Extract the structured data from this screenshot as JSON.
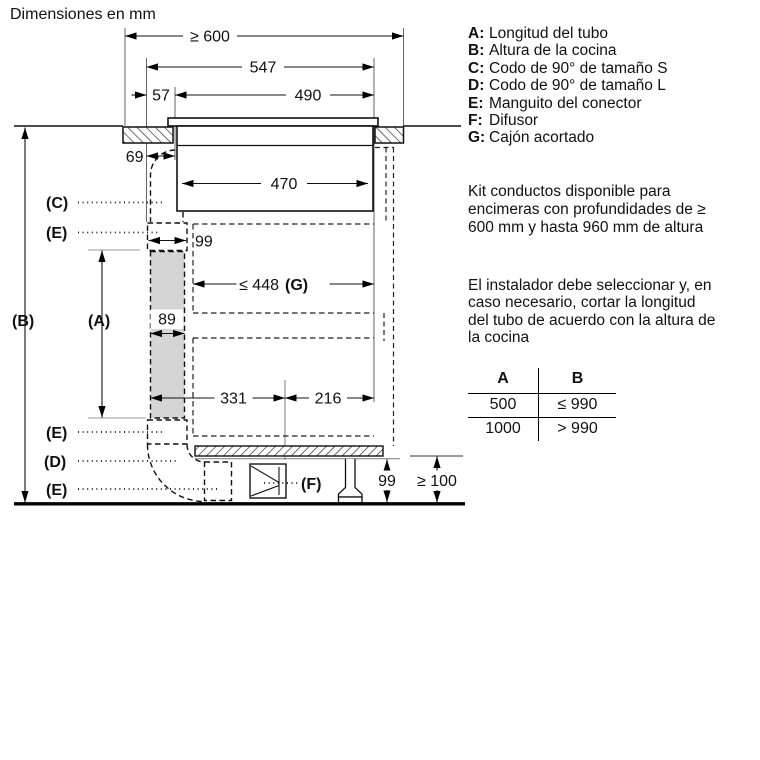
{
  "title": "Dimensiones en mm",
  "diagram": {
    "dims": {
      "d600": "≥ 600",
      "d547": "547",
      "d57": "57",
      "d490": "490",
      "d69": "69",
      "d470": "470",
      "d99_top": "99",
      "d89": "89",
      "d448": "≤ 448",
      "d448_g": "(G)",
      "d331": "331",
      "d216": "216",
      "d99_bottom": "99",
      "d100": "≥ 100"
    },
    "labels": {
      "a": "(A)",
      "b": "(B)",
      "c": "(C)",
      "d": "(D)",
      "e": "(E)",
      "f": "(F)"
    }
  },
  "legend": {
    "items": [
      {
        "key": "A:",
        "text": "Longitud del tubo"
      },
      {
        "key": "B:",
        "text": "Altura de la cocina"
      },
      {
        "key": "C:",
        "text": "Codo de 90° de tamaño S"
      },
      {
        "key": "D:",
        "text": "Codo de 90° de tamaño L"
      },
      {
        "key": "E:",
        "text": "Manguito del conector"
      },
      {
        "key": "F:",
        "text": "Difusor"
      },
      {
        "key": "G:",
        "text": "Cajón acortado"
      }
    ]
  },
  "notes": {
    "kit_lines": [
      "Kit conductos disponible para",
      "encimeras con profundidades de ≥",
      "600 mm y hasta 960 mm de altura"
    ],
    "installer_lines": [
      "El instalador debe seleccionar y, en",
      "caso necesario, cortar la longitud",
      "del tubo de acuerdo con la altura de",
      "la cocina"
    ]
  },
  "table": {
    "headers": [
      "A",
      "B"
    ],
    "rows": [
      [
        "500",
        "≤ 990"
      ],
      [
        "1000",
        "> 990"
      ]
    ]
  }
}
